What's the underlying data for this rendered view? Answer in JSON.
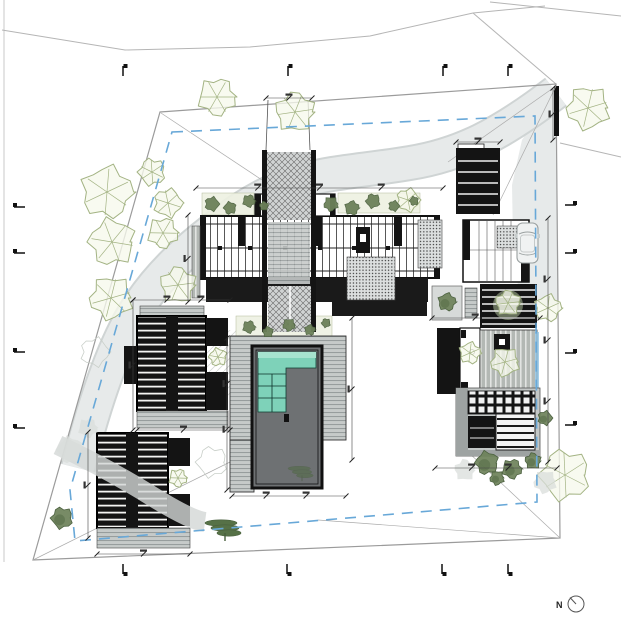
{
  "page": {
    "north_label": "N"
  },
  "palette": {
    "paper": "#ffffff",
    "ink": "#141414",
    "boundary": "#9b9b9b",
    "road": "#b5b5b5",
    "setback_blue": "#68a8d8",
    "path_gray": "#e7eaea",
    "path_edge": "#cfd4d4",
    "deck_gray": "#c6cac9",
    "deck_line": "#8f9595",
    "basin_gray": "#6e7173",
    "pool_water": "#7ed2b9",
    "pool_water_light": "#a7e3cf",
    "foliage_light_stroke": "#a3b383",
    "foliage_light_fill": "#f6f8ec",
    "foliage_dark": "#6c8159",
    "foliage_dark_stroke": "#4c6140",
    "blob_gray": "#d9dddb",
    "pine_green": "#4e6a3e",
    "dim": "#444444",
    "marker": "#111111"
  },
  "trees": [
    {
      "x": 217,
      "y": 97,
      "r": 21,
      "style": "sketch"
    },
    {
      "x": 295,
      "y": 112,
      "r": 22,
      "style": "sketch"
    },
    {
      "x": 588,
      "y": 108,
      "r": 24,
      "style": "sketch"
    },
    {
      "x": 107,
      "y": 192,
      "r": 29,
      "style": "sketch"
    },
    {
      "x": 152,
      "y": 172,
      "r": 15,
      "style": "sketch"
    },
    {
      "x": 168,
      "y": 203,
      "r": 16,
      "style": "sketch"
    },
    {
      "x": 112,
      "y": 242,
      "r": 26,
      "style": "sketch"
    },
    {
      "x": 163,
      "y": 233,
      "r": 17,
      "style": "sketch"
    },
    {
      "x": 178,
      "y": 285,
      "r": 20,
      "style": "sketch"
    },
    {
      "x": 111,
      "y": 298,
      "r": 24,
      "style": "sketch"
    },
    {
      "x": 548,
      "y": 308,
      "r": 15,
      "style": "sketch"
    },
    {
      "x": 565,
      "y": 475,
      "r": 28,
      "style": "sketch"
    },
    {
      "x": 408,
      "y": 200,
      "r": 13,
      "style": "sketch"
    },
    {
      "x": 218,
      "y": 357,
      "r": 10,
      "style": "sketch"
    },
    {
      "x": 178,
      "y": 478,
      "r": 10,
      "style": "sketch"
    },
    {
      "x": 508,
      "y": 303,
      "r": 14,
      "style": "sketch"
    },
    {
      "x": 505,
      "y": 362,
      "r": 16,
      "style": "sketch"
    },
    {
      "x": 470,
      "y": 353,
      "r": 12,
      "style": "sketch"
    },
    {
      "x": 212,
      "y": 462,
      "r": 17,
      "style": "faint"
    },
    {
      "x": 95,
      "y": 352,
      "r": 16,
      "style": "faint"
    },
    {
      "x": 70,
      "y": 450,
      "r": 15,
      "style": "gray"
    },
    {
      "x": 88,
      "y": 428,
      "r": 11,
      "style": "gray"
    },
    {
      "x": 465,
      "y": 470,
      "r": 12,
      "style": "gray"
    },
    {
      "x": 545,
      "y": 482,
      "r": 13,
      "style": "gray"
    },
    {
      "x": 447,
      "y": 302,
      "r": 10,
      "style": "dark"
    },
    {
      "x": 62,
      "y": 518,
      "r": 12,
      "style": "dark"
    },
    {
      "x": 545,
      "y": 418,
      "r": 8,
      "style": "dark"
    },
    {
      "x": 487,
      "y": 463,
      "r": 13,
      "style": "dark"
    },
    {
      "x": 512,
      "y": 469,
      "r": 11,
      "style": "dark"
    },
    {
      "x": 533,
      "y": 461,
      "r": 9,
      "style": "dark"
    },
    {
      "x": 497,
      "y": 478,
      "r": 8,
      "style": "dark"
    }
  ],
  "bushes": [
    {
      "x": 212,
      "y": 204,
      "r": 8
    },
    {
      "x": 230,
      "y": 208,
      "r": 7
    },
    {
      "x": 249,
      "y": 201,
      "r": 7
    },
    {
      "x": 264,
      "y": 206,
      "r": 5
    },
    {
      "x": 331,
      "y": 204,
      "r": 8
    },
    {
      "x": 352,
      "y": 208,
      "r": 8
    },
    {
      "x": 373,
      "y": 201,
      "r": 8
    },
    {
      "x": 394,
      "y": 206,
      "r": 6
    },
    {
      "x": 414,
      "y": 201,
      "r": 5
    },
    {
      "x": 249,
      "y": 327,
      "r": 7
    },
    {
      "x": 268,
      "y": 332,
      "r": 6
    },
    {
      "x": 289,
      "y": 325,
      "r": 7
    },
    {
      "x": 310,
      "y": 330,
      "r": 6
    },
    {
      "x": 326,
      "y": 323,
      "r": 5
    }
  ],
  "pines": [
    {
      "x": 225,
      "y": 528,
      "s": 1.0,
      "o": 0.95
    },
    {
      "x": 302,
      "y": 472,
      "s": 0.7,
      "o": 0.5
    }
  ],
  "section_markers": {
    "top": {
      "y": 66,
      "xs": [
        123,
        288,
        443,
        508
      ]
    },
    "bottom": {
      "y": 564,
      "xs": [
        123,
        287,
        442,
        508
      ]
    },
    "left": {
      "x": 14,
      "ys": [
        207,
        253,
        352,
        428
      ]
    },
    "right": {
      "x": 565,
      "ys": [
        205,
        253,
        353,
        425
      ]
    }
  },
  "dimensions": [
    {
      "x1": 196,
      "y1": 188,
      "x2": 443,
      "y2": 188,
      "mids": [
        0.25,
        0.5,
        0.75
      ]
    },
    {
      "x1": 188,
      "y1": 215,
      "x2": 188,
      "y2": 302,
      "mids": [
        0.5
      ]
    },
    {
      "x1": 133,
      "y1": 300,
      "x2": 230,
      "y2": 300,
      "mids": [
        0.35,
        0.7
      ]
    },
    {
      "x1": 133,
      "y1": 300,
      "x2": 133,
      "y2": 430,
      "mids": [
        0.5
      ]
    },
    {
      "x1": 88,
      "y1": 432,
      "x2": 88,
      "y2": 538,
      "mids": [
        0.5
      ]
    },
    {
      "x1": 97,
      "y1": 554,
      "x2": 190,
      "y2": 554,
      "mids": [
        0.5
      ]
    },
    {
      "x1": 137,
      "y1": 430,
      "x2": 230,
      "y2": 430,
      "mids": [
        0.5
      ]
    },
    {
      "x1": 227,
      "y1": 338,
      "x2": 227,
      "y2": 490,
      "mids": [
        0.3,
        0.6
      ]
    },
    {
      "x1": 232,
      "y1": 496,
      "x2": 346,
      "y2": 496,
      "mids": [
        0.3,
        0.65
      ]
    },
    {
      "x1": 352,
      "y1": 318,
      "x2": 352,
      "y2": 460,
      "mids": [
        0.5
      ]
    },
    {
      "x1": 548,
      "y1": 218,
      "x2": 548,
      "y2": 462,
      "mids": [
        0.25,
        0.5,
        0.75
      ]
    },
    {
      "x1": 435,
      "y1": 468,
      "x2": 557,
      "y2": 468,
      "mids": [
        0.3,
        0.6
      ]
    },
    {
      "x1": 456,
      "y1": 142,
      "x2": 500,
      "y2": 142,
      "mids": [
        0.5
      ]
    },
    {
      "x1": 266,
      "y1": 98,
      "x2": 312,
      "y2": 98,
      "mids": [
        0.5
      ]
    },
    {
      "x1": 553,
      "y1": 88,
      "x2": 553,
      "y2": 140,
      "mids": [
        0.5
      ]
    },
    {
      "x1": 432,
      "y1": 318,
      "x2": 540,
      "y2": 318,
      "mids": [
        0.4
      ]
    }
  ],
  "north_arrow": {
    "cx": 576,
    "cy": 604,
    "r": 8
  }
}
